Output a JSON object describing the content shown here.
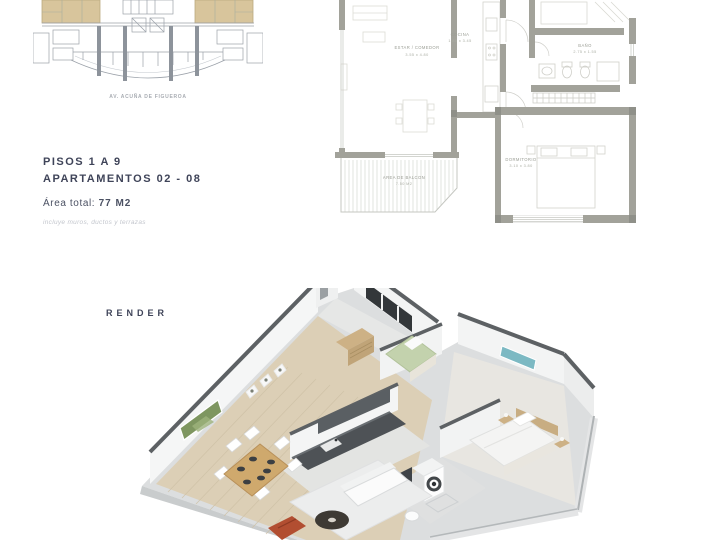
{
  "key_plan": {
    "caption": "AV. ACUÑA DE FIGUEROA"
  },
  "info": {
    "floors": "PISOS 1 A 9",
    "apartments": "APARTAMENTOS 02 - 08",
    "area_label": "Área total:",
    "area_value": "77 M2",
    "note": "incluye muros, ductos y terrazas"
  },
  "floor_plan": {
    "rooms": [
      {
        "name": "ESTAR / COMEDOR",
        "dims": "3.55 x 4.80"
      },
      {
        "name": "COCINA",
        "dims": "1.80 x 3.45"
      },
      {
        "name": "BAÑO",
        "dims": "2.75 x 1.55"
      },
      {
        "name": "DORMITORIO",
        "dims": "3.10 x 3.80"
      },
      {
        "name": "AREA DE BALCON",
        "dims": "7.50 M2"
      }
    ]
  },
  "render": {
    "label": "RENDER"
  },
  "colors": {
    "unit_highlight": "#d8c59c",
    "plan_wall": "#a2a29a",
    "heading_text": "#3f4459",
    "muted_text": "#c3c6cd",
    "render_wall_top": "#5d6164",
    "wood_floor": "#dccfb6",
    "accent_red_chair": "#b24e31",
    "accent_teal_art": "#7cb9c3",
    "accent_green_art": "#7e9660"
  }
}
